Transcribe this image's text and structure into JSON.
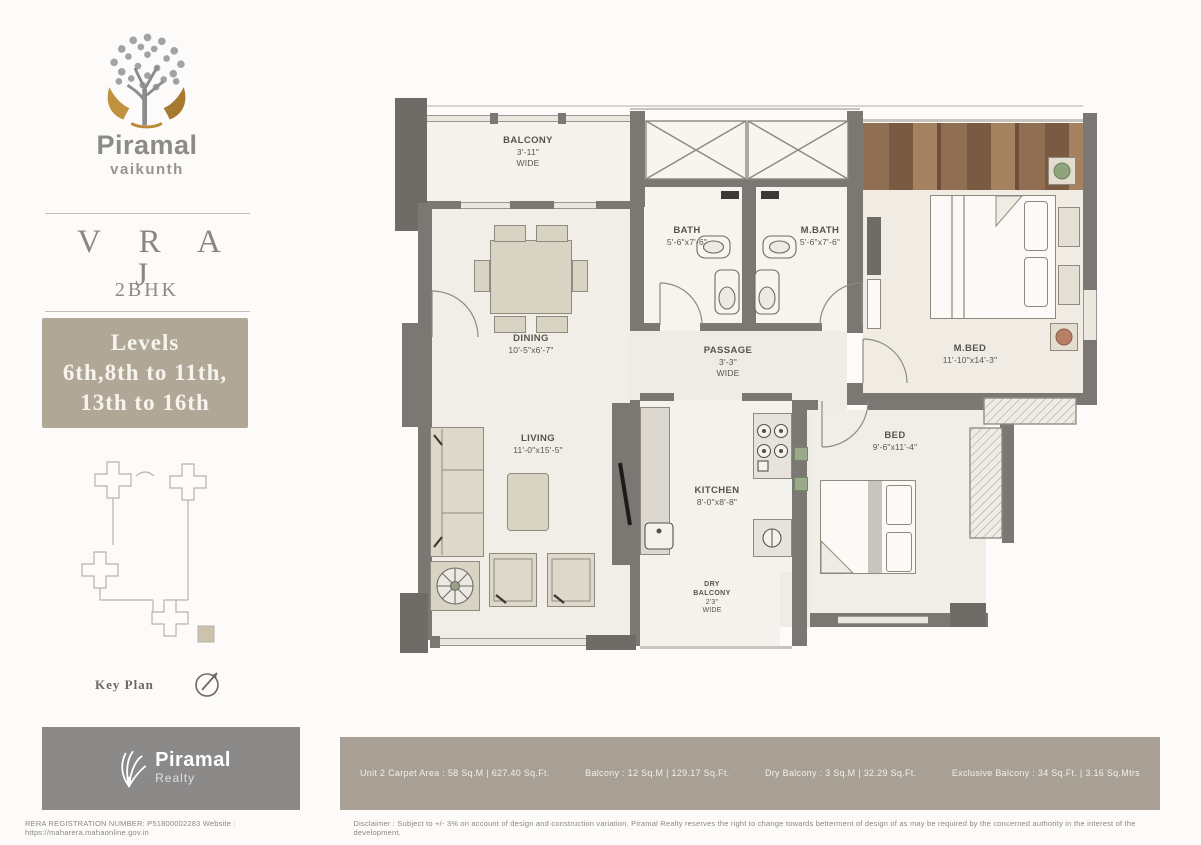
{
  "sidebar": {
    "brand_name": "Piramal",
    "brand_sub": "vaikunth",
    "plan_name": "V R A J",
    "plan_type": "2BHK",
    "levels_lines": [
      "Levels",
      "6th,8th to 11th,",
      "13th to 16th"
    ],
    "key_plan_label": "Key Plan"
  },
  "plan": {
    "rooms": [
      {
        "label": "BALCONY",
        "dims": "3'-11\"",
        "note": "WIDE"
      },
      {
        "label": "BATH",
        "dims": "5'-6\"x7'-6\""
      },
      {
        "label": "M.BATH",
        "dims": "5'-6\"x7'-6\""
      },
      {
        "label": "DINING",
        "dims": "10'-5\"x6'-7\""
      },
      {
        "label": "M.BED",
        "dims": "11'-10\"x14'-3\""
      },
      {
        "label": "PASSAGE",
        "dims": "3'-3\"",
        "note": "WIDE"
      },
      {
        "label": "LIVING",
        "dims": "11'-0\"x15'-5\""
      },
      {
        "label": "KITCHEN",
        "dims": "8'-0\"x8'-8\""
      },
      {
        "label": "BED",
        "dims": "9'-6\"x11'-4\""
      },
      {
        "label": "DRY",
        "label2": "BALCONY",
        "dims": "2'3\"",
        "note": "WIDE"
      }
    ]
  },
  "footer": {
    "realty_name": "Piramal",
    "realty_sub": "Realty",
    "area_segments": [
      "Unit 2 Carpet Area : 58 Sq.M | 627.40 Sq.Ft.",
      "Balcony : 12 Sq.M | 129.17 Sq.Ft.",
      "Dry Balcony : 3 Sq.M | 32.29 Sq.Ft.",
      "Exclusive Balcony : 34 Sq.Ft. | 3.16 Sq.Mtrs"
    ],
    "rera_line": "RERA REGISTRATION NUMBER: P51800002283     Website : https://maharera.mahaonline.gov.in",
    "disclaimer": "Disclaimer : Subject to +/- 3% on account of design and construction variation. Piramal Realty reserves the right to change towards betterment of design of as may be required by the concerned authority in the interest of the development."
  },
  "colors": {
    "wall": "#7b7772",
    "floor": "#f1eee7",
    "levels_box": "#b1a797",
    "area_bar": "#a8a094",
    "wood_deck": "#8f6e52"
  }
}
